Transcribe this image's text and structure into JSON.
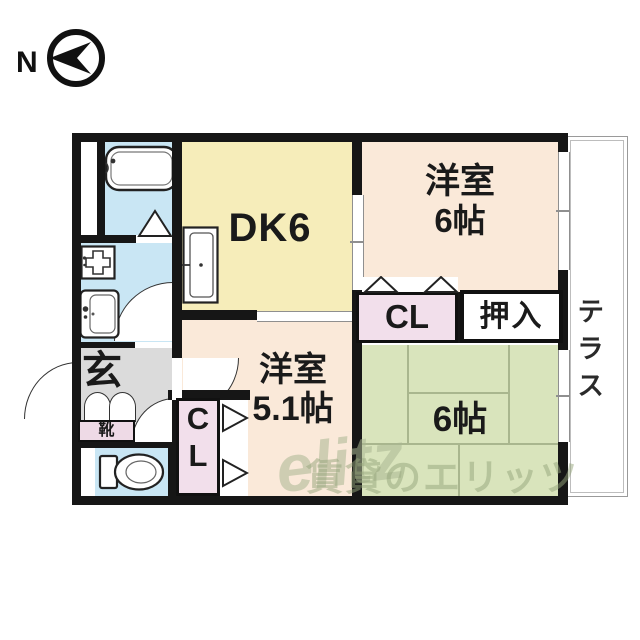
{
  "compass": {
    "label": "N"
  },
  "rooms": {
    "dk": {
      "label": "DK6"
    },
    "west_top": {
      "name": "洋室",
      "size": "6帖"
    },
    "west_mid": {
      "name": "洋室",
      "size": "5.1帖"
    },
    "tatami": {
      "size": "6帖"
    },
    "closet_top": {
      "label": "CL"
    },
    "oshiire": {
      "label": "押入"
    },
    "closet_bottom": {
      "line1": "C",
      "line2": "L"
    },
    "genkan": {
      "label": "玄"
    },
    "shoes": {
      "label": "靴"
    },
    "terrace": {
      "label": "テラス"
    }
  },
  "watermark": {
    "script": "elitz",
    "text": "賃貸のエリッツ"
  },
  "colors": {
    "wall": "#161616",
    "water_blue": "#c9e6f4",
    "dk_yellow": "#f6edba",
    "western_peach": "#fae9d9",
    "closet_pink": "#f2dfeb",
    "tatami_green": "#d9e4bc",
    "hall_gray": "#dbdbdb",
    "tatami_line": "#a9b68e",
    "watermark_green": "#94a47a"
  }
}
